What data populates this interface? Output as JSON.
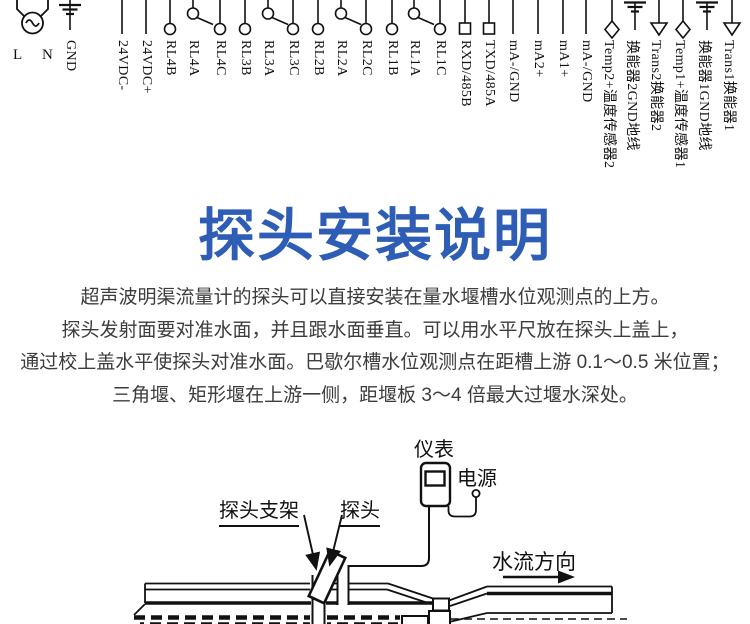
{
  "title": "探头安装说明",
  "title_color": "#2e5db6",
  "line_color": "#111111",
  "terminal_strip": {
    "ac_l_label": "L",
    "ac_n_label": "N",
    "terminals": [
      {
        "label": "GND",
        "symbol": "ground",
        "x": 70
      },
      {
        "label": "24VDC-",
        "symbol": "plain",
        "x": 122
      },
      {
        "label": "24VDC+",
        "symbol": "plain",
        "x": 146
      },
      {
        "label": "RL4B",
        "symbol": "circle",
        "x": 170
      },
      {
        "label": "RL4A",
        "symbol": "circle-com",
        "x": 193
      },
      {
        "label": "RL4C",
        "symbol": "circle",
        "x": 220
      },
      {
        "label": "RL3B",
        "symbol": "circle",
        "x": 245
      },
      {
        "label": "RL3A",
        "symbol": "circle-com",
        "x": 268
      },
      {
        "label": "RL3C",
        "symbol": "circle",
        "x": 293
      },
      {
        "label": "RL2B",
        "symbol": "circle",
        "x": 318
      },
      {
        "label": "RL2A",
        "symbol": "circle-com",
        "x": 341
      },
      {
        "label": "RL2C",
        "symbol": "circle",
        "x": 366
      },
      {
        "label": "RL1B",
        "symbol": "circle",
        "x": 392
      },
      {
        "label": "RL1A",
        "symbol": "circle-com",
        "x": 414
      },
      {
        "label": "RL1C",
        "symbol": "circle",
        "x": 440
      },
      {
        "label": "RXD/485B",
        "symbol": "square",
        "x": 465
      },
      {
        "label": "TXD/485A",
        "symbol": "square",
        "x": 489
      },
      {
        "label": "mA-/GND",
        "symbol": "plain",
        "x": 513
      },
      {
        "label": "mA2+",
        "symbol": "plain",
        "x": 538
      },
      {
        "label": "mA1+",
        "symbol": "plain",
        "x": 563
      },
      {
        "label": "mA-/GND",
        "symbol": "plain",
        "x": 586
      },
      {
        "label": "Temp2+温度传感器2",
        "symbol": "diamond",
        "x": 612
      },
      {
        "label": "换能器2GND地线",
        "symbol": "ground-top",
        "x": 635
      },
      {
        "label": "Trans2换能器2",
        "symbol": "triangle",
        "x": 659
      },
      {
        "label": "Temp1+温度传感器1",
        "symbol": "diamond",
        "x": 683
      },
      {
        "label": "换能器1GND地线",
        "symbol": "ground-top",
        "x": 707
      },
      {
        "label": "Trans1换能器1",
        "symbol": "triangle",
        "x": 732
      }
    ]
  },
  "paragraph": {
    "lines": [
      "超声波明渠流量计的探头可以直接安装在量水堰槽水位观测点的上方。",
      "探头发射面要对准水面，并且跟水面垂直。可以用水平尺放在探头上盖上，",
      "通过校上盖水平使探头对准水面。巴歇尔槽水位观测点在距槽上游 0.1～0.5 米位置；",
      "三角堰、矩形堰在上游一侧，距堰板 3～4 倍最大过堰水深处。"
    ]
  },
  "diagram": {
    "meter_label": "仪表",
    "power_label": "电源",
    "probe_bracket_label": "探头支架",
    "probe_label": "探头",
    "flow_direction_label": "水流方向"
  }
}
